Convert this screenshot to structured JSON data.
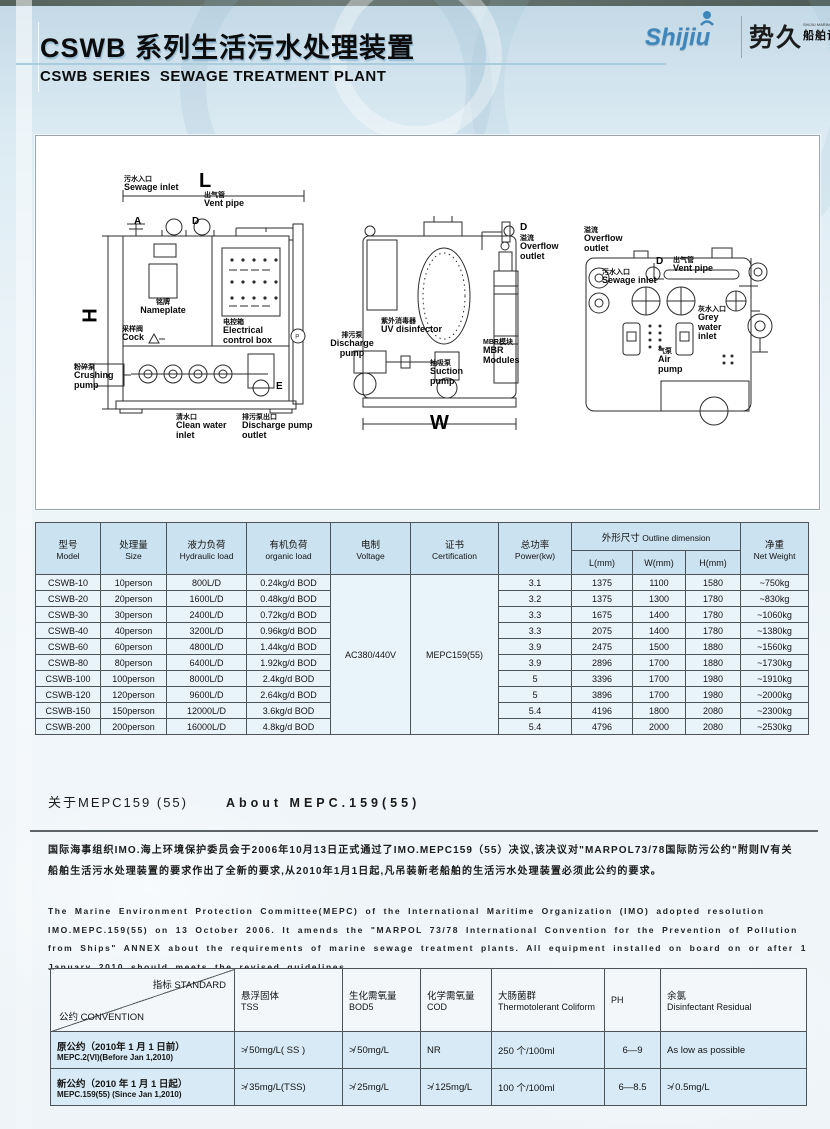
{
  "colors": {
    "logo_blue": "#3f86bb",
    "table_header_bg": "#cbe2f0",
    "table_row_bg": "#e9f3fa",
    "standards_row_bg": "#d7eaf5",
    "title_color": "#0c0c0c"
  },
  "header": {
    "title_cn": "CSWB 系列生活污水处理装置",
    "title_en": "CSWB SERIES  SEWAGE TREATMENT PLANT",
    "logo": {
      "brand_en": "Shijiu",
      "brand_cn": "势久",
      "sub_en": "SHIJIU MARINE EQUIPT",
      "sub_cn": "船舶设备"
    }
  },
  "diagram": {
    "dims": {
      "length": "L",
      "height": "H",
      "width": "W",
      "depth": "D",
      "a": "A",
      "e": "E",
      "p": "P"
    },
    "view1": {
      "sewage_inlet": {
        "cn": "污水入口",
        "en": "Sewage inlet"
      },
      "vent_pipe": {
        "cn": "出气管",
        "en": "Vent pipe"
      },
      "nameplate": {
        "cn": "铭牌",
        "en": "Nameplate"
      },
      "electrical_control_box": {
        "cn": "电控箱",
        "en": "Electrical control box"
      },
      "cock": {
        "cn": "采样阀",
        "en": "Cock"
      },
      "crushing_pump": {
        "cn": "粉碎泵",
        "en": "Crushing pump"
      },
      "clean_water_inlet": {
        "cn": "清水口",
        "en": "Clean water inlet"
      },
      "discharge_pump_outlet": {
        "cn": "排污泵出口",
        "en": "Discharge pump outlet"
      }
    },
    "view2": {
      "overflow_outlet": {
        "cn": "溢流",
        "en": "Overflow outlet"
      },
      "discharge_pump": {
        "cn": "排污泵",
        "en": "Discharge pump"
      },
      "uv_disinfector": {
        "cn": "紫外消毒器",
        "en": "UV disinfector"
      },
      "suction_pump": {
        "cn": "抽吸泵",
        "en": "Suction pump"
      },
      "mbr_modules": {
        "cn": "MBR模块",
        "en": "MBR Modules"
      }
    },
    "view3": {
      "overflow_outlet": {
        "cn": "溢流",
        "en": "Overflow outlet"
      },
      "sewage_inlet": {
        "cn": "污水入口",
        "en": "Sewage inlet"
      },
      "vent_pipe": {
        "cn": "出气管",
        "en": "Vent pipe"
      },
      "grey_water_inlet": {
        "cn": "灰水入口",
        "en": "Grey water inlet"
      },
      "air_pump": {
        "cn": "气泵",
        "en": "Air pump"
      }
    }
  },
  "spec_table": {
    "header_cols": [
      {
        "cn": "型号",
        "en": "Model"
      },
      {
        "cn": "处理量",
        "en": "Size"
      },
      {
        "cn": "液力负荷",
        "en": "Hydraulic load"
      },
      {
        "cn": "有机负荷",
        "en": "organic load"
      },
      {
        "cn": "电制",
        "en": "Voltage"
      },
      {
        "cn": "证书",
        "en": "Certification"
      },
      {
        "cn": "总功率",
        "en": "Power(kw)"
      },
      {
        "cn": "净重",
        "en": "Net Weight"
      }
    ],
    "outline_group": {
      "cn": "外形尺寸",
      "en": "Outline dimension"
    },
    "outline_sub": [
      "L(mm)",
      "W(mm)",
      "H(mm)"
    ],
    "voltage": "AC380/440V",
    "certification": "MEPC159(55)",
    "rows": [
      [
        "CSWB-10",
        "10person",
        "800L/D",
        "0.24kg/d BOD",
        "3.1",
        "1375",
        "1100",
        "1580",
        "~750kg"
      ],
      [
        "CSWB-20",
        "20person",
        "1600L/D",
        "0.48kg/d BOD",
        "3.2",
        "1375",
        "1300",
        "1780",
        "~830kg"
      ],
      [
        "CSWB-30",
        "30person",
        "2400L/D",
        "0.72kg/d BOD",
        "3.3",
        "1675",
        "1400",
        "1780",
        "~1060kg"
      ],
      [
        "CSWB-40",
        "40person",
        "3200L/D",
        "0.96kg/d BOD",
        "3.3",
        "2075",
        "1400",
        "1780",
        "~1380kg"
      ],
      [
        "CSWB-60",
        "60person",
        "4800L/D",
        "1.44kg/d BOD",
        "3.9",
        "2475",
        "1500",
        "1880",
        "~1560kg"
      ],
      [
        "CSWB-80",
        "80person",
        "6400L/D",
        "1.92kg/d BOD",
        "3.9",
        "2896",
        "1700",
        "1880",
        "~1730kg"
      ],
      [
        "CSWB-100",
        "100person",
        "8000L/D",
        "2.4kg/d BOD",
        "5",
        "3396",
        "1700",
        "1980",
        "~1910kg"
      ],
      [
        "CSWB-120",
        "120person",
        "9600L/D",
        "2.64kg/d BOD",
        "5",
        "3896",
        "1700",
        "1980",
        "~2000kg"
      ],
      [
        "CSWB-150",
        "150person",
        "12000L/D",
        "3.6kg/d BOD",
        "5.4",
        "4196",
        "1800",
        "2080",
        "~2300kg"
      ],
      [
        "CSWB-200",
        "200person",
        "16000L/D",
        "4.8kg/d BOD",
        "5.4",
        "4796",
        "2000",
        "2080",
        "~2530kg"
      ]
    ]
  },
  "mepc_section": {
    "heading_cn": "关于MEPC159 (55)",
    "heading_en": "About MEPC.159(55)",
    "para_cn": "国际海事组织IMO.海上环境保护委员会于2006年10月13日正式通过了IMO.MEPC159（55）决议,该决议对\"MARPOL73/78国际防污公约\"附则Ⅳ有关船舶生活污水处理装置的要求作出了全新的要求,从2010年1月1日起,凡吊装新老船舶的生活污水处理装置必须此公约的要求。",
    "para_en": "The Marine Environment Protection Committee(MEPC) of the International Maritime Organization (IMO) adopted resolution IMO.MEPC.159(55) on 13 October 2006. It amends the \"MARPOL 73/78 International Convention for the Prevention of Pollution from Ships\" ANNEX about the requirements of marine sewage treatment plants. All equipment installed on board on or after 1 January 2010 should meets the revised guidelines ."
  },
  "standards_table": {
    "corner_top": "指标 STANDARD",
    "corner_bottom": "公约 CONVENTION",
    "columns": [
      {
        "cn": "悬浮固体",
        "en": "TSS"
      },
      {
        "cn": "生化需氧量",
        "en": "BOD5"
      },
      {
        "cn": "化学需氧量",
        "en": "COD"
      },
      {
        "cn": "大肠菌群",
        "en": "Thermotolerant Coliform"
      },
      {
        "cn": "",
        "en": "PH"
      },
      {
        "cn": "余氯",
        "en": "Disinfectant Residual"
      }
    ],
    "rows": [
      {
        "label_cn": "原公约（2010年 1 月 1 日前）",
        "label_en": "MEPC.2(VI)(Before Jan 1,2010)",
        "values": [
          "≯ 50mg/L( SS )",
          "≯ 50mg/L",
          "NR",
          "250 个/100ml",
          "6—9",
          "As low as possible"
        ]
      },
      {
        "label_cn": "新公约（2010 年 1 月 1 日起）",
        "label_en": "MEPC.159(55) (Since Jan 1,2010)",
        "values": [
          "≯ 35mg/L(TSS)",
          "≯ 25mg/L",
          "≯ 125mg/L",
          "100 个/100ml",
          "6—8.5",
          "≯ 0.5mg/L"
        ]
      }
    ]
  }
}
